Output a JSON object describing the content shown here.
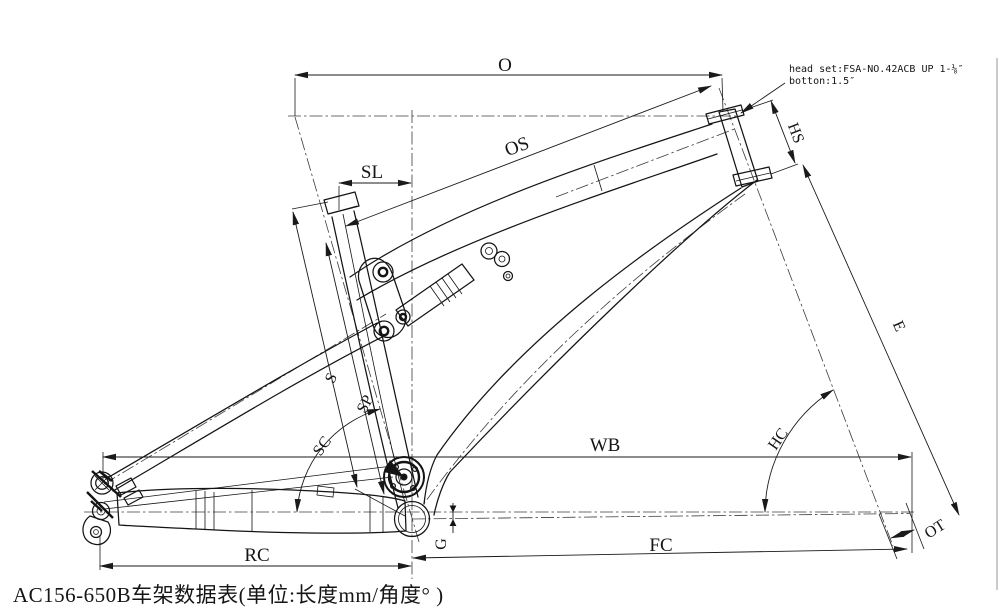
{
  "drawing": {
    "footer_title": "AC156-650B车架数据表(单位:长度mm/角度° )",
    "headset_note": {
      "line1": "head set:FSA-NO.42ACB  UP 1-⅛″",
      "line2": "botton:1.5″"
    },
    "dimensions": {
      "effective_top_tube": "O",
      "actual_top_tube": "OS",
      "seat_setback": "SL",
      "head_tube_length": "HS",
      "fork_length": "E",
      "wheelbase": "WB",
      "head_tube_angle": "HC",
      "seat_tube_length": "S",
      "seatpost": "SP",
      "seat_tube_angle": "SC",
      "bb_drop": "G",
      "rear_center": "RC",
      "front_center": "FC",
      "fork_offset": "OT"
    },
    "colors": {
      "ink": "#1a1a1a",
      "centerline": "#3c3c3c",
      "background": "#ffffff",
      "sheet_border": "#8a8a8a"
    }
  }
}
